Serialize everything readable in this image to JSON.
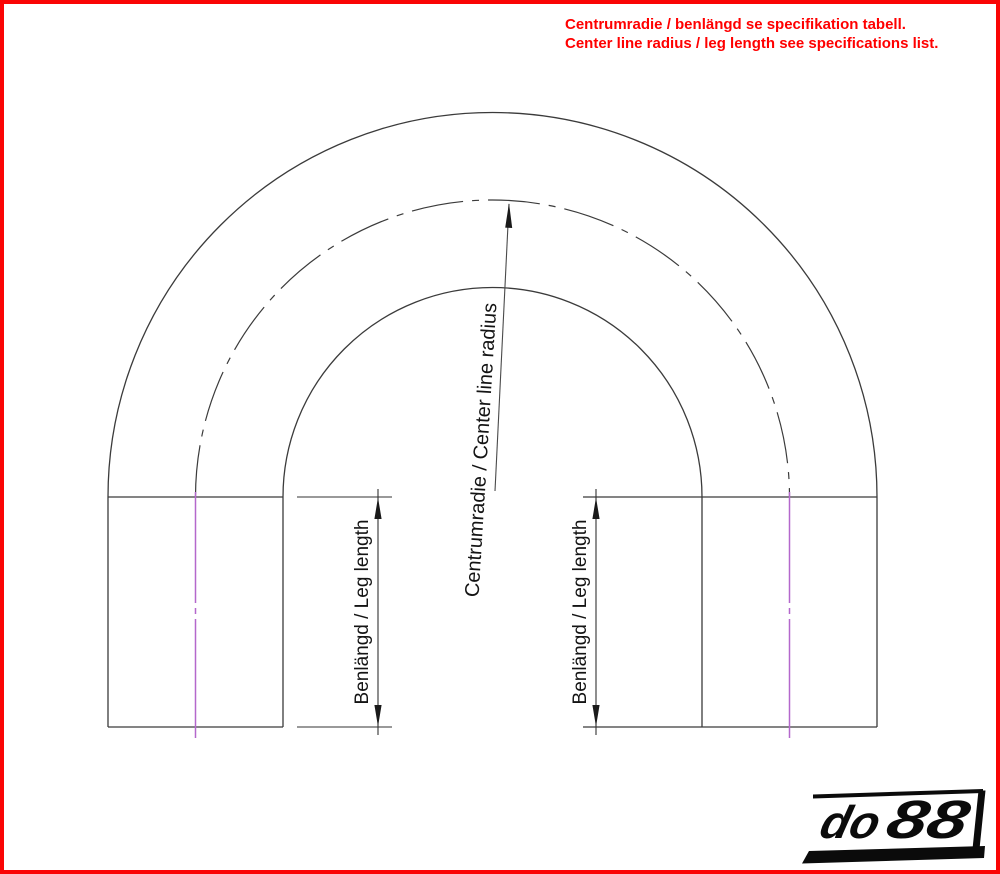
{
  "annotation": {
    "line1": "Centrumradie / benlängd se specifikation tabell.",
    "line2": "Center line radius / leg length see specifications list."
  },
  "drawing": {
    "center_radius_label": "Centrumradie / Center line radius",
    "leg_length_label_left": "Benlängd / Leg length",
    "leg_length_label_right": "Benlängd / Leg length"
  },
  "logo": {
    "part1": "do",
    "part2": "88"
  },
  "colors": {
    "accent_red": "#FF0000",
    "centerline_magenta": "#B468CC",
    "drawing_line": "#3B3B3B"
  }
}
